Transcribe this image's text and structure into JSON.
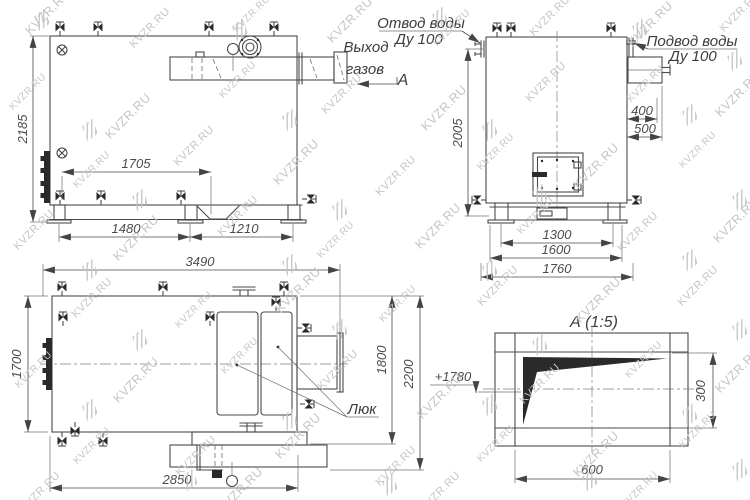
{
  "watermark": {
    "text": "KVZR.RU"
  },
  "side_view": {
    "gas_outlet_line1": "Выход",
    "gas_outlet_line2": "газов",
    "section_mark": "А",
    "overall_height": "2185",
    "flue_dim": "1705",
    "support_span_front": "1480",
    "support_span_rear": "1210"
  },
  "front_view": {
    "water_outlet_line1": "Отвод воды",
    "water_outlet_line2": "Ду 100",
    "water_inlet_line1": "Подвод воды",
    "water_inlet_line2": "Ду 100",
    "height_to_outlet": "2005",
    "inlet_offset": "400",
    "inlet_depth": "500",
    "base_span_inner": "1300",
    "base_span_outer": "1600",
    "overall_width": "1760"
  },
  "plan_view": {
    "hatch_label": "Люк",
    "overall_length": "3490",
    "body_width": "1700",
    "width_to_platform": "1800",
    "overall_width": "2200",
    "platform_length": "2850"
  },
  "detail_view": {
    "title": "А (1:5)",
    "level_mark": "+1780",
    "opening_height": "300",
    "opening_width": "600"
  }
}
